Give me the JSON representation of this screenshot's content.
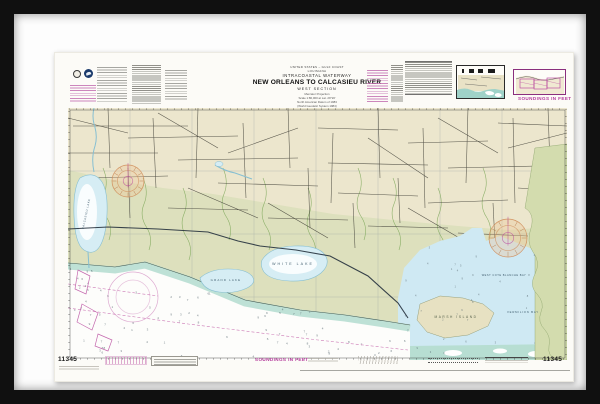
{
  "artwork": {
    "kind": "framed nautical chart",
    "frame_color": "#101010",
    "mat_color": "#fdfdfd",
    "paper_color": "#fcfbf7"
  },
  "chart": {
    "chart_number": "11345",
    "soundings_note": "SOUNDINGS IN FEET",
    "title_block": {
      "region": "UNITED STATES – GULF COAST",
      "state": "LOUISIANA",
      "series": "INTRACOASTAL WATERWAY",
      "title": "NEW ORLEANS TO CALCASIEU RIVER",
      "subtitle": "WEST SECTION",
      "projection": "Mercator Projection",
      "scale": "Scale 1:80,000 at Lat. 29°20'",
      "datum": "North American Datum of 1983",
      "datum2": "(World Geodetic System 1984)"
    },
    "map_labels": {
      "calcasieu_lake": "CALCASIEU LAKE",
      "grand_lake": "GRAND LAKE",
      "white_lake": "WHITE LAKE",
      "marsh_island": "MARSH ISLAND",
      "west_cote_blanche_bay": "WEST COTE BLANCHE BAY",
      "vermilion_bay": "VERMILION BAY"
    },
    "colors": {
      "magenta_accent": "#b5399b",
      "land_tan": "#ece6cd",
      "marsh_olive": "#dde0bd",
      "lake_blue": "#d6edf4",
      "shallow_teal": "#b7ded2",
      "gulf_white": "#fdfdfb",
      "east_land_green": "#d3dcae"
    }
  }
}
